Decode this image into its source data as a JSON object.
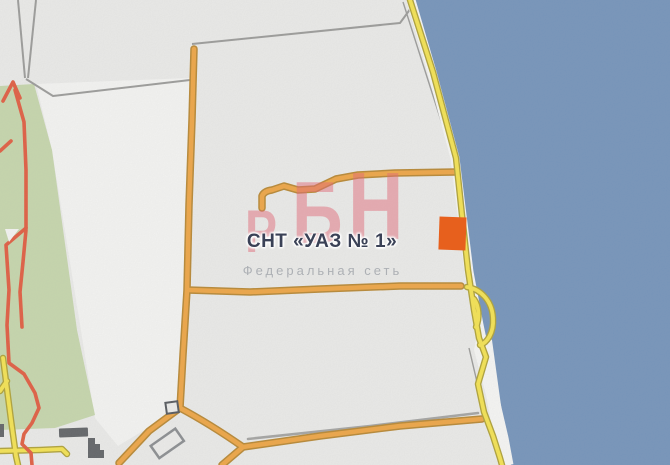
{
  "map": {
    "settlement_label": "СНТ «УАЗ № 1»",
    "watermark": {
      "letters": [
        "Р",
        "Б",
        "Н"
      ],
      "subtitle": "Федеральная сеть"
    },
    "marker": {
      "shape": "orange-square"
    }
  },
  "colors": {
    "land": "#ECECEA",
    "land_bright": "#F6F6F4",
    "water": "#7292BA",
    "beach": "#F8F8F6",
    "park_green": "#C6D7AB",
    "road_orange": "#F0A541",
    "road_orange_casing": "#B8862F",
    "road_yellow": "#F6E44E",
    "road_yellow_casing": "#AFA133",
    "boundary_gray": "#9A9A98",
    "trail_red": "#E25A3D",
    "building_dark": "#5E6164",
    "building_light": "#EDEDEB",
    "marker_orange": "#E7601D",
    "watermark_pink": "#E06A78",
    "label_navy": "#3A4156",
    "subtitle_gray": "#A7ABB0"
  }
}
